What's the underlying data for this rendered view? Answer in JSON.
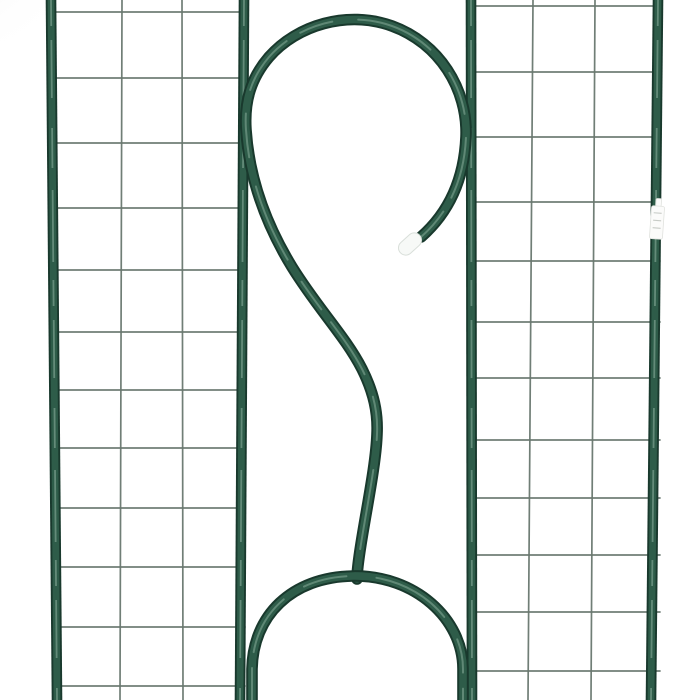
{
  "scene": {
    "background_color": "#ffffff",
    "corner_shadow_color": "#e7e7e7",
    "tube_width": 11,
    "wire_width": 1.7,
    "colors": {
      "tube_edge": "#19392d",
      "tube_mid": "#2e5c49",
      "tube_highlight": "#90b3a1",
      "wire": "#68776f",
      "cap_fill": "#f7f9f7",
      "cap_border": "#d9dfda",
      "tag_fill": "#fbfbfa",
      "tag_border": "#e0e2de",
      "tag_marks": "#c2c6c1"
    }
  },
  "panels": {
    "left": {
      "outer_tube": {
        "x_top": 51,
        "x_bottom": 57
      },
      "inner_tube": {
        "x_top": 244,
        "x_bottom": 240
      },
      "vertical_wires": [
        {
          "x_top": 122,
          "x_bottom": 120
        },
        {
          "x_top": 182,
          "x_bottom": 183
        }
      ],
      "horizontal_wire_ys": [
        12,
        78,
        143,
        208,
        270,
        332,
        390,
        448,
        508,
        567,
        627,
        686
      ],
      "wire_span": {
        "x1": 53,
        "x2": 245
      }
    },
    "right": {
      "outer_tube": {
        "x_top": 658,
        "x_bottom": 651
      },
      "inner_tube": {
        "x_top": 471,
        "x_bottom": 472
      },
      "vertical_wires": [
        {
          "x_top": 533,
          "x_bottom": 528
        },
        {
          "x_top": 595,
          "x_bottom": 591
        }
      ],
      "horizontal_wire_ys": [
        6,
        72,
        137,
        202,
        261,
        322,
        378,
        440,
        498,
        555,
        612,
        671
      ],
      "wire_span": {
        "x1": 470,
        "x2": 660
      }
    }
  },
  "ornament": {
    "end_cap": {
      "cx": 410,
      "cy": 244,
      "length": 26,
      "thickness": 14.5,
      "angle_deg": 138
    },
    "tag": {
      "x": 650.5,
      "y": 206,
      "width": 13,
      "height": 33,
      "angle_deg": 4,
      "loop": {
        "x": 654.5,
        "y": 198.5,
        "width": 5.5,
        "height": 8
      }
    }
  }
}
